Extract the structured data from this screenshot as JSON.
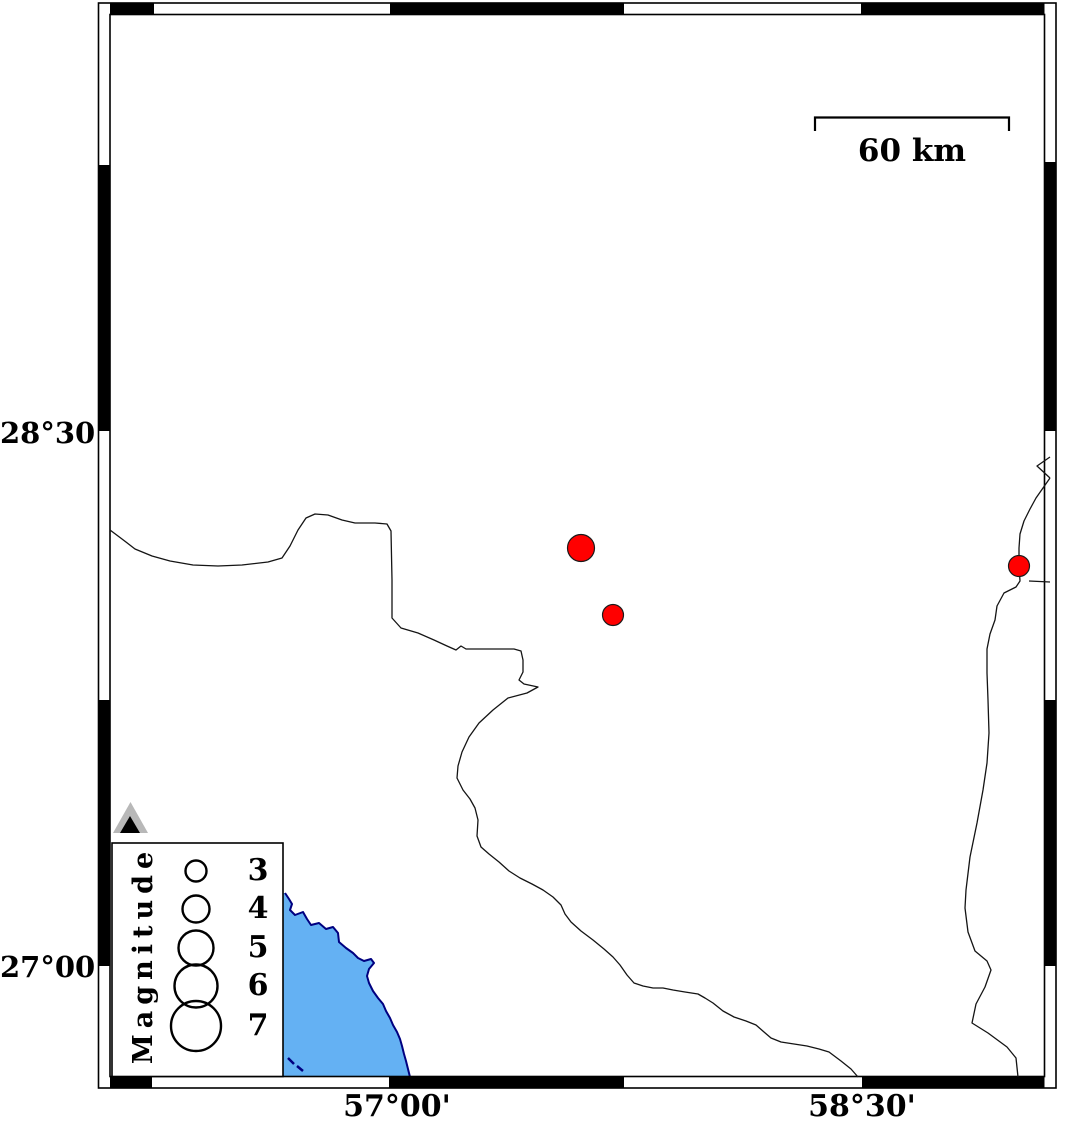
{
  "map": {
    "axis": {
      "left": [
        {
          "text": "28°30'"
        },
        {
          "text": "27°00'"
        }
      ],
      "bottom": [
        {
          "text": "57°00'"
        },
        {
          "text": "58°30'"
        }
      ]
    },
    "scale_bar": {
      "label": "60 km"
    },
    "legend": {
      "title": "Magnitude",
      "entries": [
        {
          "label": "3",
          "cy": 871,
          "r": 10.5
        },
        {
          "label": "4",
          "cy": 909,
          "r": 13.5
        },
        {
          "label": "5",
          "cy": 948,
          "r": 17.5
        },
        {
          "label": "6",
          "cy": 986,
          "r": 21.5
        },
        {
          "label": "7",
          "cy": 1026,
          "r": 25
        }
      ]
    },
    "epicenters": [
      {
        "x": 581,
        "y": 548,
        "r": 13.5
      },
      {
        "x": 613,
        "y": 615,
        "r": 10.5
      },
      {
        "x": 1019,
        "y": 566,
        "r": 10.5
      }
    ],
    "station": {
      "x": 130.5,
      "y": 833
    },
    "colors": {
      "epicenter": "#ff0000",
      "water": "#64b1f3",
      "coastline": "#000080",
      "station_fill": "#b8b8b8",
      "station_inner": "#000000",
      "frame": "#000000"
    }
  }
}
